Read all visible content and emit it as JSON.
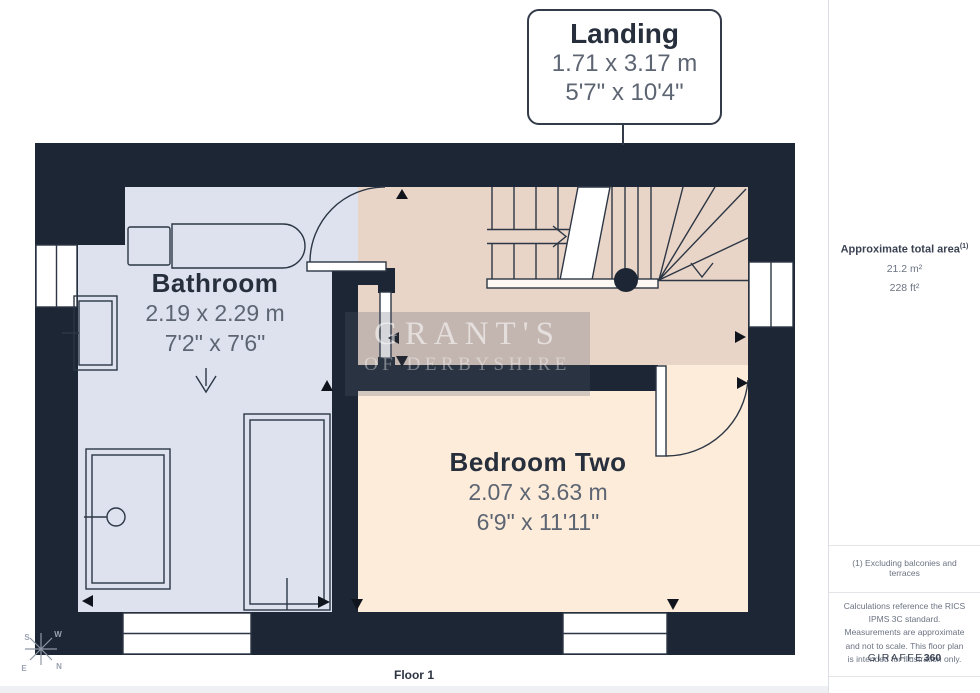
{
  "callout": {
    "room_name": "Landing",
    "dim_metric": "1.71 x 3.17 m",
    "dim_imperial": "5'7\" x 10'4\""
  },
  "rooms": {
    "bathroom": {
      "name": "Bathroom",
      "dim_metric": "2.19 x 2.29 m",
      "dim_imperial": "7'2\" x 7'6\""
    },
    "bedroom_two": {
      "name": "Bedroom Two",
      "dim_metric": "2.07 x 3.63 m",
      "dim_imperial": "6'9\" x 11'11\""
    }
  },
  "watermark": {
    "line1": "GRANT'S",
    "line2": "OF DERBYSHIRE"
  },
  "sidebar": {
    "area_title": "Approximate total area",
    "area_superscript": "(1)",
    "area_metric": "21.2 m²",
    "area_imperial": "228 ft²",
    "footnote": "(1) Excluding balconies and terraces",
    "disclaimer": "Calculations reference the RICS IPMS 3C standard. Measurements are approximate and not to scale. This floor plan is intended for illustration only.",
    "brand_name": "GIRAFFE",
    "brand_suffix": "360"
  },
  "compass": {
    "n": "N",
    "s": "S",
    "e": "E",
    "w": "W"
  },
  "floor_label": "Floor 1",
  "colors": {
    "wall": "#1d2634",
    "bathroom_fill": "#dde2ee",
    "landing_fill": "#e9d5c8",
    "bedroom_fill": "#fcecd9",
    "line": "#2c3644",
    "arrow": "#10151d"
  }
}
